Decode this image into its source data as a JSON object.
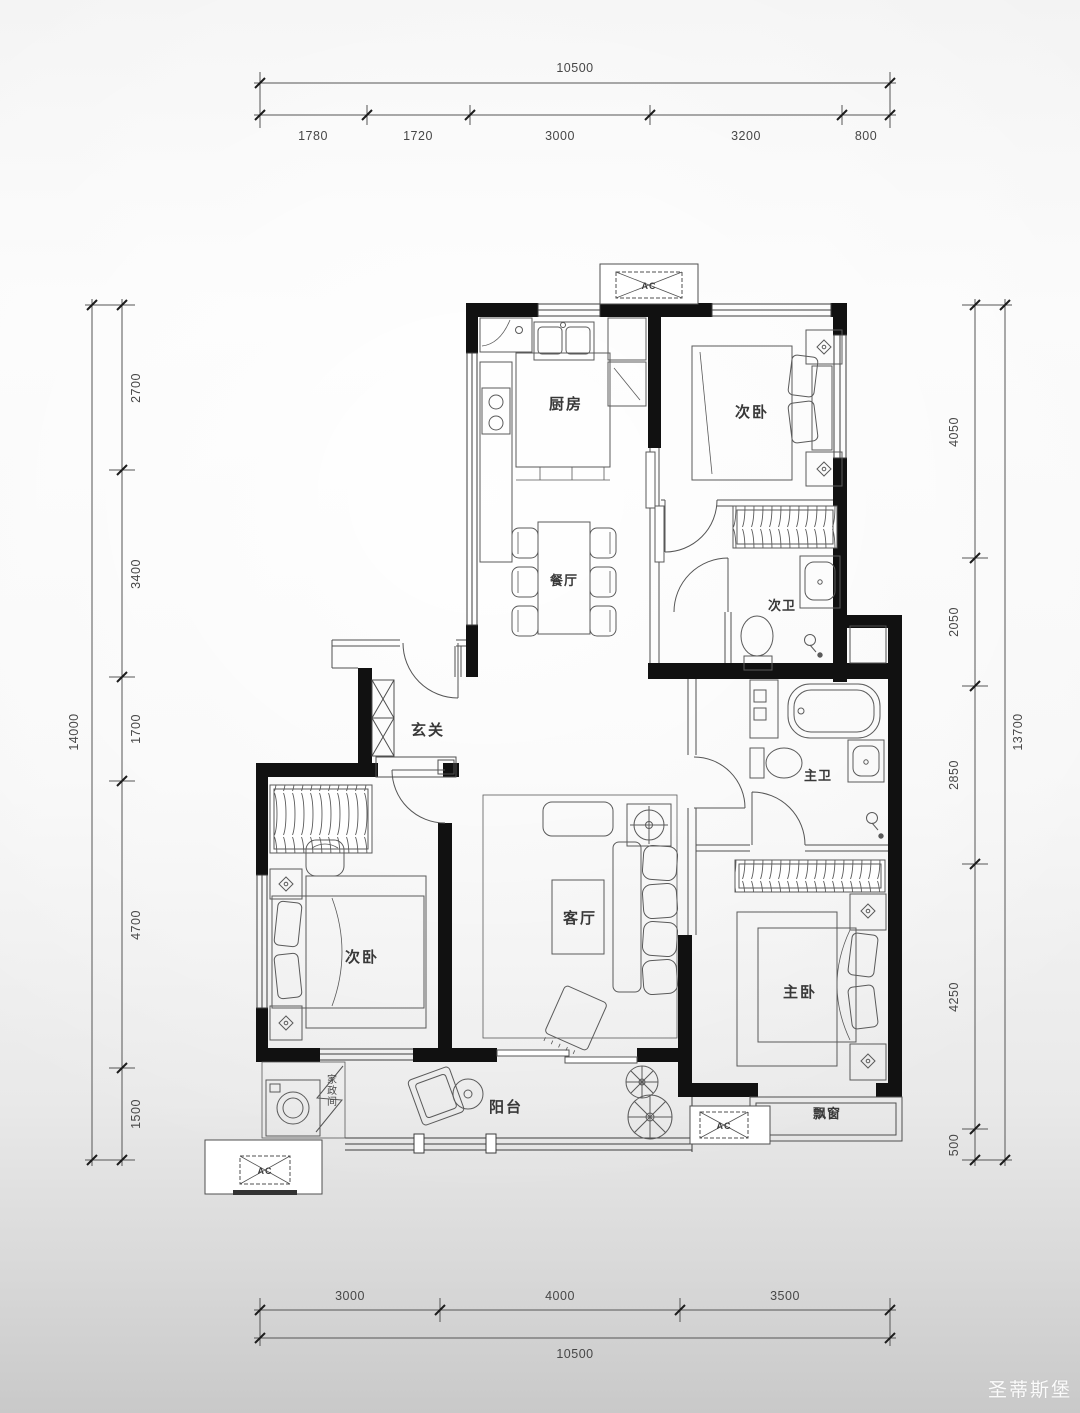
{
  "labels": {
    "kitchen": "厨房",
    "bedroom_top": "次卧",
    "bedroom_left": "次卧",
    "bedroom_master": "主卧",
    "bath_second": "次卫",
    "bath_master": "主卫",
    "dining": "餐厅",
    "living": "客厅",
    "foyer": "玄关",
    "balcony": "阳台",
    "bay_window": "飘窗",
    "laundry": "家政间",
    "ac_unit": "AC"
  },
  "dimensions": {
    "top": {
      "total": "10500",
      "segments": [
        "1780",
        "1720",
        "3000",
        "3200",
        "800"
      ]
    },
    "left": {
      "total": "14000",
      "segments": [
        "2700",
        "3400",
        "1700",
        "4700",
        "1500"
      ]
    },
    "right": {
      "total": "13700",
      "segments": [
        "4050",
        "2050",
        "2850",
        "4250",
        "500"
      ]
    },
    "bottom": {
      "total": "10500",
      "segments": [
        "3000",
        "4000",
        "3500"
      ]
    }
  },
  "watermark": {
    "text": "圣蒂斯堡"
  },
  "colors": {
    "wall": "#111111",
    "line": "#4f4f4f",
    "text": "#333333",
    "watermark_text": "#ffffff"
  }
}
